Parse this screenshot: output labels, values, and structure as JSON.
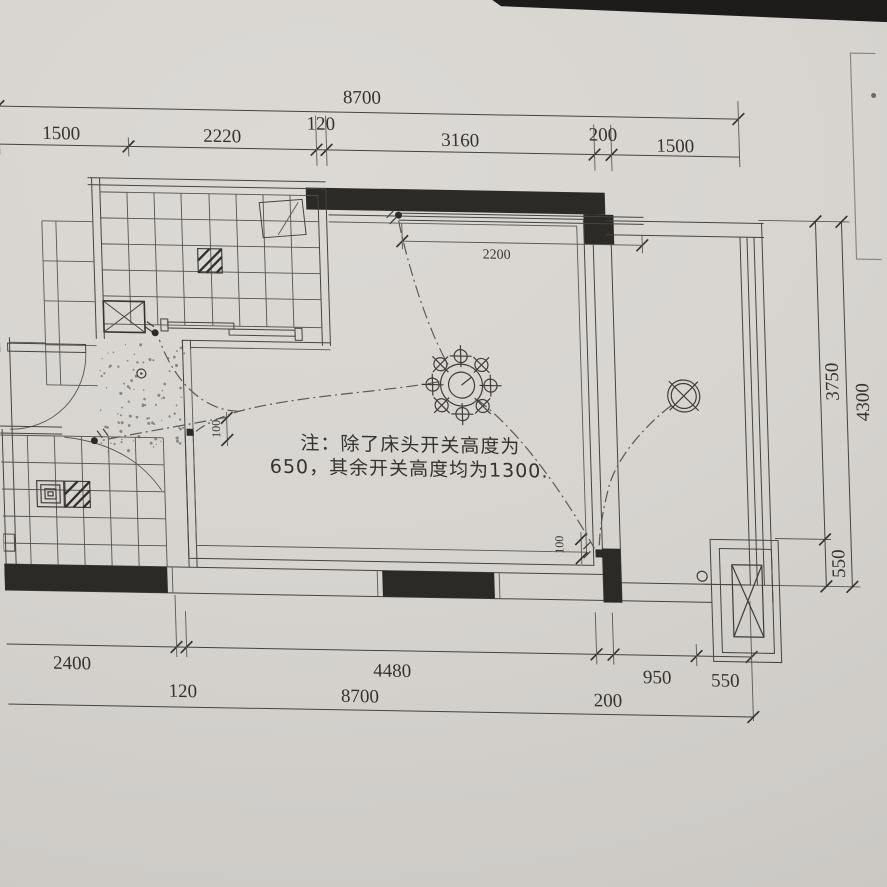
{
  "note": {
    "line1": "注：除了床头开关高度为",
    "line2": "650，其余开关高度均为1300."
  },
  "dims": {
    "top": {
      "overall": "8700",
      "segments": [
        "1500",
        "2220",
        "120",
        "3160",
        "200",
        "1500"
      ]
    },
    "bottom": {
      "overall": "8700",
      "segments": [
        "2400",
        "120",
        "4480",
        "200",
        "950",
        "550"
      ]
    },
    "right": {
      "overall": "4300",
      "segments": [
        "3750",
        "550"
      ]
    },
    "interior": {
      "bay_window_width": "2200",
      "bedroom_door_offset": "100",
      "balcony_door_offset": "100"
    }
  },
  "symbols": {
    "chandelier": "ceiling-chandelier",
    "balcony_light": "ceiling-light",
    "wall_switch": "wall-switch",
    "floor_drain": "floor-drain",
    "duct_shaft": "duct-shaft",
    "column": "concrete-column",
    "ac_platform": "ac-outdoor-unit-platform"
  },
  "colors": {
    "paper": "#d6d3cf",
    "ink": "#3f3d3a",
    "wall": "#2b2a27"
  }
}
